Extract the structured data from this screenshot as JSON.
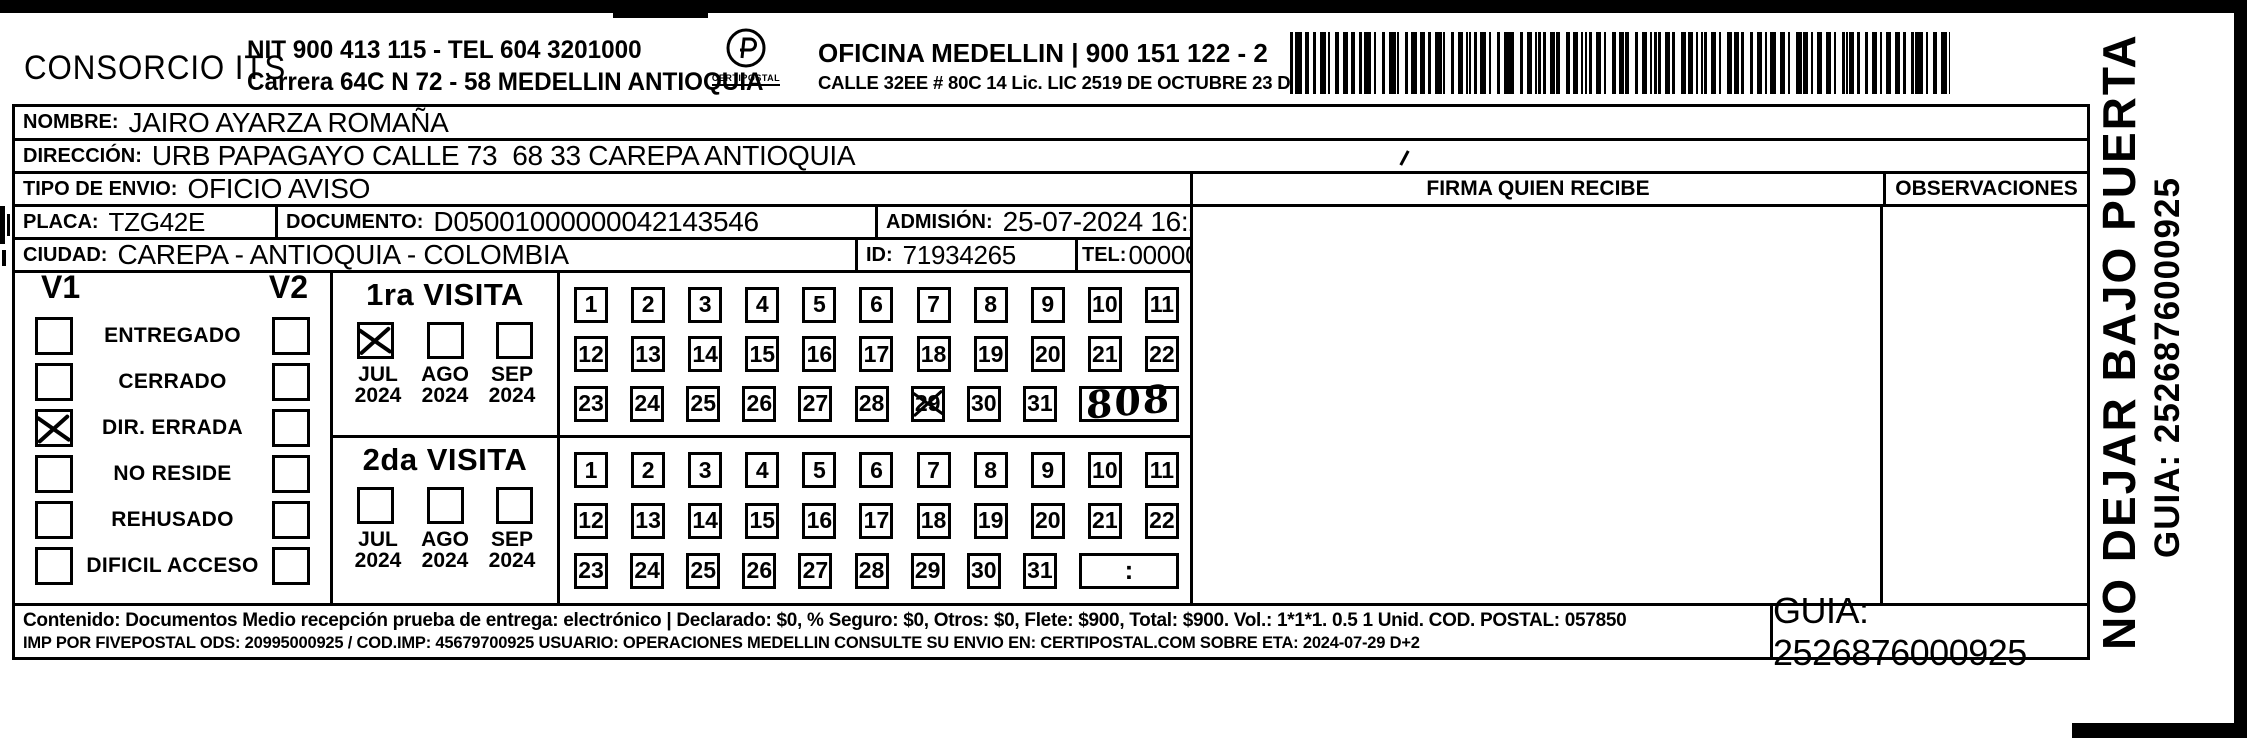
{
  "header": {
    "company": "CONSORCIO ITS",
    "nit_line1": "NIT 900 413 115 - TEL 604 3201000",
    "nit_line2": "Carrera 64C N 72 - 58 MEDELLIN ANTIOQUIA",
    "logo_text": "CERTIPOSTAL",
    "office_line1": "OFICINA MEDELLIN | 900 151 122 - 2",
    "office_line2": "CALLE 32EE # 80C 14 Lic. LIC 2519 DE OCTUBRE 23 DE 2015"
  },
  "recipient": {
    "nombre_label": "NOMBRE:",
    "nombre": "JAIRO AYARZA ROMAÑA",
    "direccion_label": "DIRECCIÓN:",
    "direccion": "URB PAPAGAYO CALLE 73  68 33 CAREPA ANTIOQUIA",
    "tipo_envio_label": "TIPO DE ENVIO:",
    "tipo_envio": "OFICIO AVISO",
    "placa_label": "PLACA:",
    "placa": "TZG42E",
    "documento_label": "DOCUMENTO:",
    "documento": "D05001000000042143546",
    "admision_label": "ADMISIÓN:",
    "admision": "25-07-2024 16:29:37",
    "ciudad_label": "CIUDAD:",
    "ciudad": "CAREPA - ANTIOQUIA - COLOMBIA",
    "id_label": "ID:",
    "id": "71934265",
    "tel_label": "TEL:",
    "tel": "0000000"
  },
  "signature": {
    "firma_header": "FIRMA QUIEN RECIBE",
    "observaciones_header": "OBSERVACIONES"
  },
  "visits": {
    "v1_label": "V1",
    "v2_label": "V2",
    "status_rows": [
      {
        "label": "ENTREGADO",
        "v1": false,
        "v2": false
      },
      {
        "label": "CERRADO",
        "v1": false,
        "v2": false
      },
      {
        "label": "DIR. ERRADA",
        "v1": true,
        "v2": false
      },
      {
        "label": "NO RESIDE",
        "v1": false,
        "v2": false
      },
      {
        "label": "REHUSADO",
        "v1": false,
        "v2": false
      },
      {
        "label": "DIFICIL ACCESO",
        "v1": false,
        "v2": false
      }
    ],
    "visit1": {
      "title": "1ra VISITA",
      "months": [
        {
          "month": "JUL",
          "year": "2024",
          "checked": true
        },
        {
          "month": "AGO",
          "year": "2024",
          "checked": false
        },
        {
          "month": "SEP",
          "year": "2024",
          "checked": false
        }
      ],
      "day_rows": [
        [
          1,
          2,
          3,
          4,
          5,
          6,
          7,
          8,
          9,
          10,
          11
        ],
        [
          12,
          13,
          14,
          15,
          16,
          17,
          18,
          19,
          20,
          21,
          22
        ],
        [
          23,
          24,
          25,
          26,
          27,
          28,
          29,
          30,
          31
        ]
      ],
      "crossed_day": 29,
      "time_value": "808",
      "time_handwritten": true
    },
    "visit2": {
      "title": "2da VISITA",
      "months": [
        {
          "month": "JUL",
          "year": "2024",
          "checked": false
        },
        {
          "month": "AGO",
          "year": "2024",
          "checked": false
        },
        {
          "month": "SEP",
          "year": "2024",
          "checked": false
        }
      ],
      "day_rows": [
        [
          1,
          2,
          3,
          4,
          5,
          6,
          7,
          8,
          9,
          10,
          11
        ],
        [
          12,
          13,
          14,
          15,
          16,
          17,
          18,
          19,
          20,
          21,
          22
        ],
        [
          23,
          24,
          25,
          26,
          27,
          28,
          29,
          30,
          31
        ]
      ],
      "crossed_day": null,
      "time_value": ":",
      "time_handwritten": false
    }
  },
  "footer": {
    "line1": "Contenido: Documentos Medio recepción prueba de entrega: electrónico | Declarado: $0, % Seguro: $0, Otros: $0, Flete: $900, Total: $900. Vol.: 1*1*1. 0.5  1 Unid. COD. POSTAL: 057850",
    "line2": "IMP POR FIVEPOSTAL ODS: 20995000925 / COD.IMP: 45679700925 USUARIO: OPERACIONES MEDELLIN CONSULTE SU ENVIO EN: CERTIPOSTAL.COM SOBRE ETA: 2024-07-29 D+2",
    "guia": "GUIA: 2526876000925"
  },
  "side": {
    "warning": "NO DEJAR BAJO PUERTA",
    "guia": "GUIA: 2526876000925"
  }
}
